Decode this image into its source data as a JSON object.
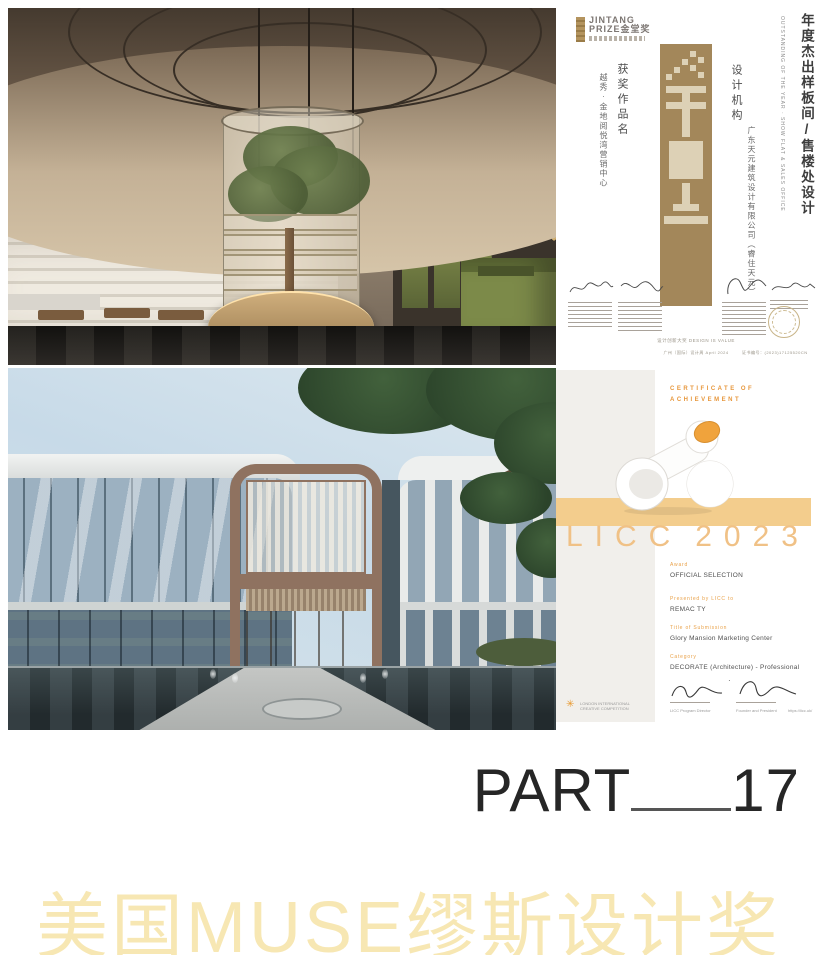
{
  "jintang": {
    "logo_line1": "JINTANG",
    "logo_line2": "PRIZE金堂奖",
    "title_cn": "年度杰出样板间/售楼处设计",
    "title_en": "OUTSTANDING OF THE YEAR · SHOW FLAT & SALES OFFICE",
    "work_label": "获奖作品名",
    "work_value": "越秀·金地阅悦湾营销中心",
    "org_label": "设计机构",
    "org_value": "广东天元建筑设计有限公司（睿住天元）",
    "footer_center": "设计创新大奖 DESIGN IS VALUE",
    "footer_sub": "广州（国际）设计周 April 2024",
    "cert_no": "证书编号：(2023)17125520CN",
    "colors": {
      "tower_brown": "#A3875A",
      "cream": "#DDD1B6"
    }
  },
  "licc": {
    "header_line1": "CERTIFICATE OF",
    "header_line2": "ACHIEVEMENT",
    "brand": "LICC",
    "year": "2023",
    "award_label": "Award",
    "award_value": "OFFICIAL SELECTION",
    "presented_label": "Presented by LICC to",
    "presented_value": "REMAC TY",
    "title_label": "Title of Submission",
    "title_value": "Glory Mansion Marketing Center",
    "category_label": "Category",
    "category_value": "DECORATE (Architecture) - Professional",
    "sig_left_role": "LICC Program Director",
    "sig_right_role": "Founder and President",
    "url": "https://licc.uk/",
    "org_line1": "LONDON INTERNATIONAL",
    "org_line2": "CREATIVE COMPETITION",
    "colors": {
      "band": "#F3CD8D",
      "accent": "#E9A24A"
    }
  },
  "part": {
    "label": "PART",
    "number": "17"
  },
  "muse_title": "美国MUSE缪斯设计奖",
  "colors": {
    "muse_gold": "#F7E7B3"
  }
}
